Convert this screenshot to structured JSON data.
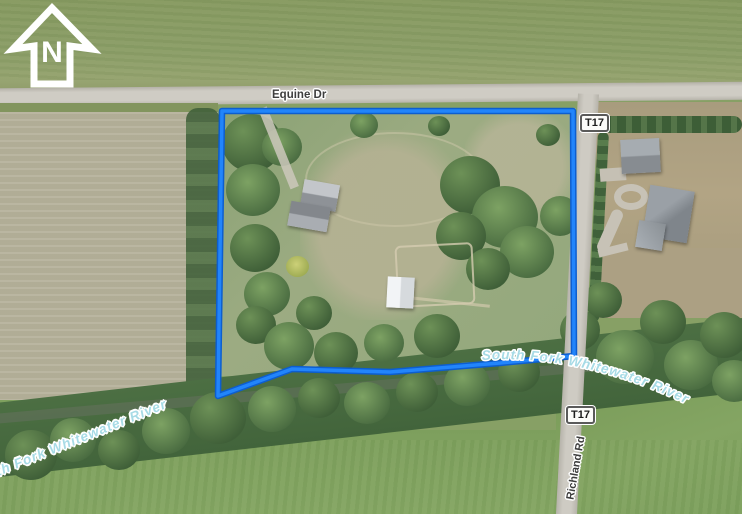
{
  "north": {
    "label": "N"
  },
  "roads": {
    "equine": "Equine Dr",
    "richland": "Richland Rd"
  },
  "shields": [
    {
      "label": "T17"
    },
    {
      "label": "T17"
    }
  ],
  "river": {
    "left_label": "South Fork Whitewater River",
    "right_label": "South Fork Whitewater River"
  },
  "boundary": {
    "points": "222,111 573,111 574,356 500,363 390,372 292,369 218,396",
    "color": "#1478f0"
  },
  "colors": {
    "boundary_blue": "#1478f0",
    "river_label_blue": "#a7dbe6",
    "road_label_gray": "#3e3e3e",
    "road_surface": "#cbc8c0",
    "crop_field_tan": "#b5b19a"
  }
}
